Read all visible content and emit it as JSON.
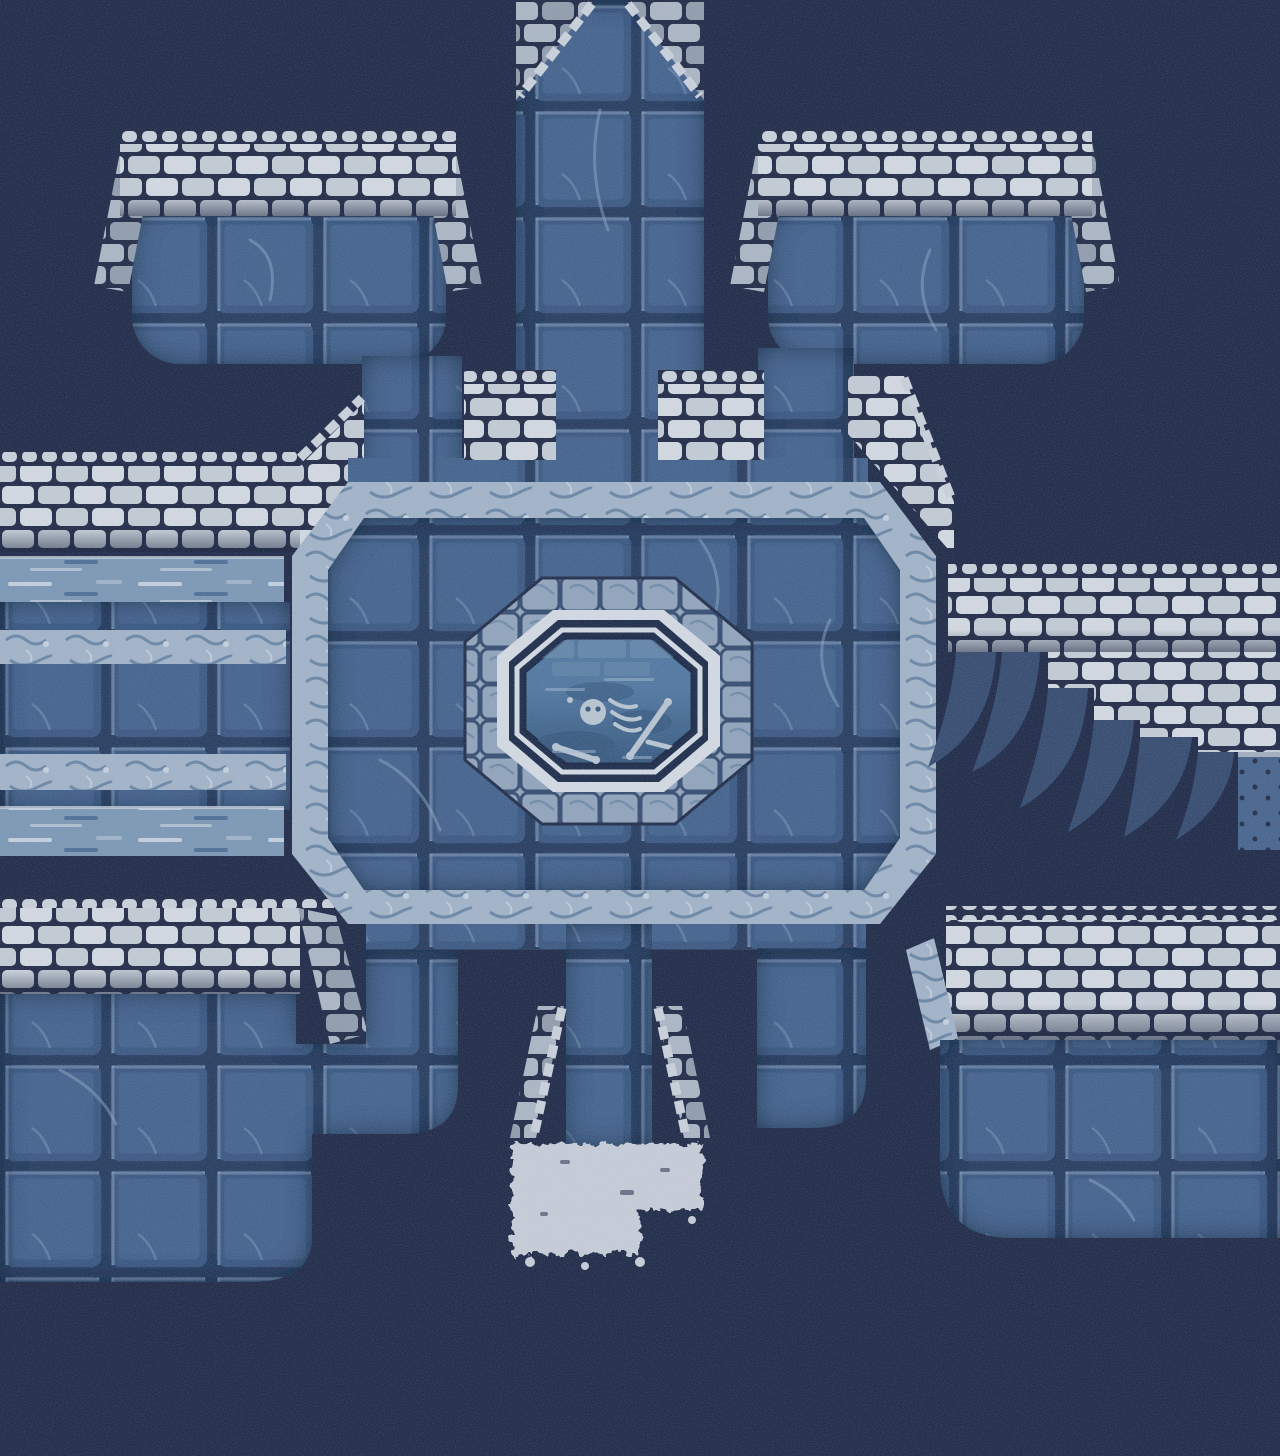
{
  "meta": {
    "title": "Dungeon keep map with central bone pool",
    "style": "blue monochrome pixel-art, top-down dungeon scene",
    "canvas": {
      "width": 1280,
      "height": 1456
    }
  },
  "palette": {
    "bg": "#141e3c",
    "tile_base": "#3b5a85",
    "tile_dark": "#243c64",
    "tile_grout": "#1f3254",
    "tile_highlight": "#85a0c0",
    "brick_light": "#d2d8df",
    "brick_mid": "#c2c9d2",
    "brick_gap": "#161f3b",
    "brick_side_light": "#a9b3c0",
    "brick_side_mid": "#8d98a7",
    "coping": "#c9cfd8",
    "marble_base": "#9fb0c5",
    "marble_swirl": "#64809f",
    "marble_light": "#c4cfdc",
    "water_base": "#7793b0",
    "water_light": "#c2cedb",
    "water_dark": "#40608c",
    "pool_block": "#8da0b7",
    "pool_rim": "#d3d9e0",
    "pool_gap": "#12203f",
    "water_deep": "#2e5076",
    "water_mid": "#4a7099",
    "underwater_brick": "#6f8fb0",
    "bone": "#b7c2ce",
    "understair": "#2b4166",
    "dots_wall": "#3f5c86",
    "dot": "#16223f",
    "light_spill": "#c5cbd5",
    "shadow": "#0a142e"
  },
  "regions": [
    {
      "name": "north-corridor",
      "desc": "vertical tiled corridor entering from top edge through a chamfered brick opening"
    },
    {
      "name": "platform-top-left",
      "desc": "rounded tiled platform with white brick parapet"
    },
    {
      "name": "platform-top-right",
      "desc": "rounded tiled platform with white brick parapet and leg joining the hall"
    },
    {
      "name": "west-rampart",
      "desc": "white brick wall running to left edge, angling up toward the hall corner"
    },
    {
      "name": "water-channel-upper",
      "desc": "horizontal water channel on the west side"
    },
    {
      "name": "west-walkway",
      "desc": "tiled walkway between two water channels, edged with pale stone trim"
    },
    {
      "name": "water-channel-lower",
      "desc": "second horizontal water channel"
    },
    {
      "name": "west-lower-wall",
      "desc": "white brick wall below the lower channel with corner cap"
    },
    {
      "name": "central-hall",
      "desc": "large octagonal tiled hall with pale marbled trim border"
    },
    {
      "name": "bone-pool",
      "desc": "octagonal pool ringed by stone blocks and a silver rim, skeleton remains underwater"
    },
    {
      "name": "east-staircase",
      "desc": "white brick staircase descending to the right with curved shadow wedges"
    },
    {
      "name": "platform-bottom-left",
      "desc": "large tiled platform below the west wall, stepped outline"
    },
    {
      "name": "platform-bottom-right",
      "desc": "tiled platform with brick parapet in lower right"
    },
    {
      "name": "south-corridor",
      "desc": "corridor leaving the hall bottom between chamfered brick jambs"
    },
    {
      "name": "doorway-light",
      "desc": "pale light spilling through the south doorway"
    }
  ]
}
